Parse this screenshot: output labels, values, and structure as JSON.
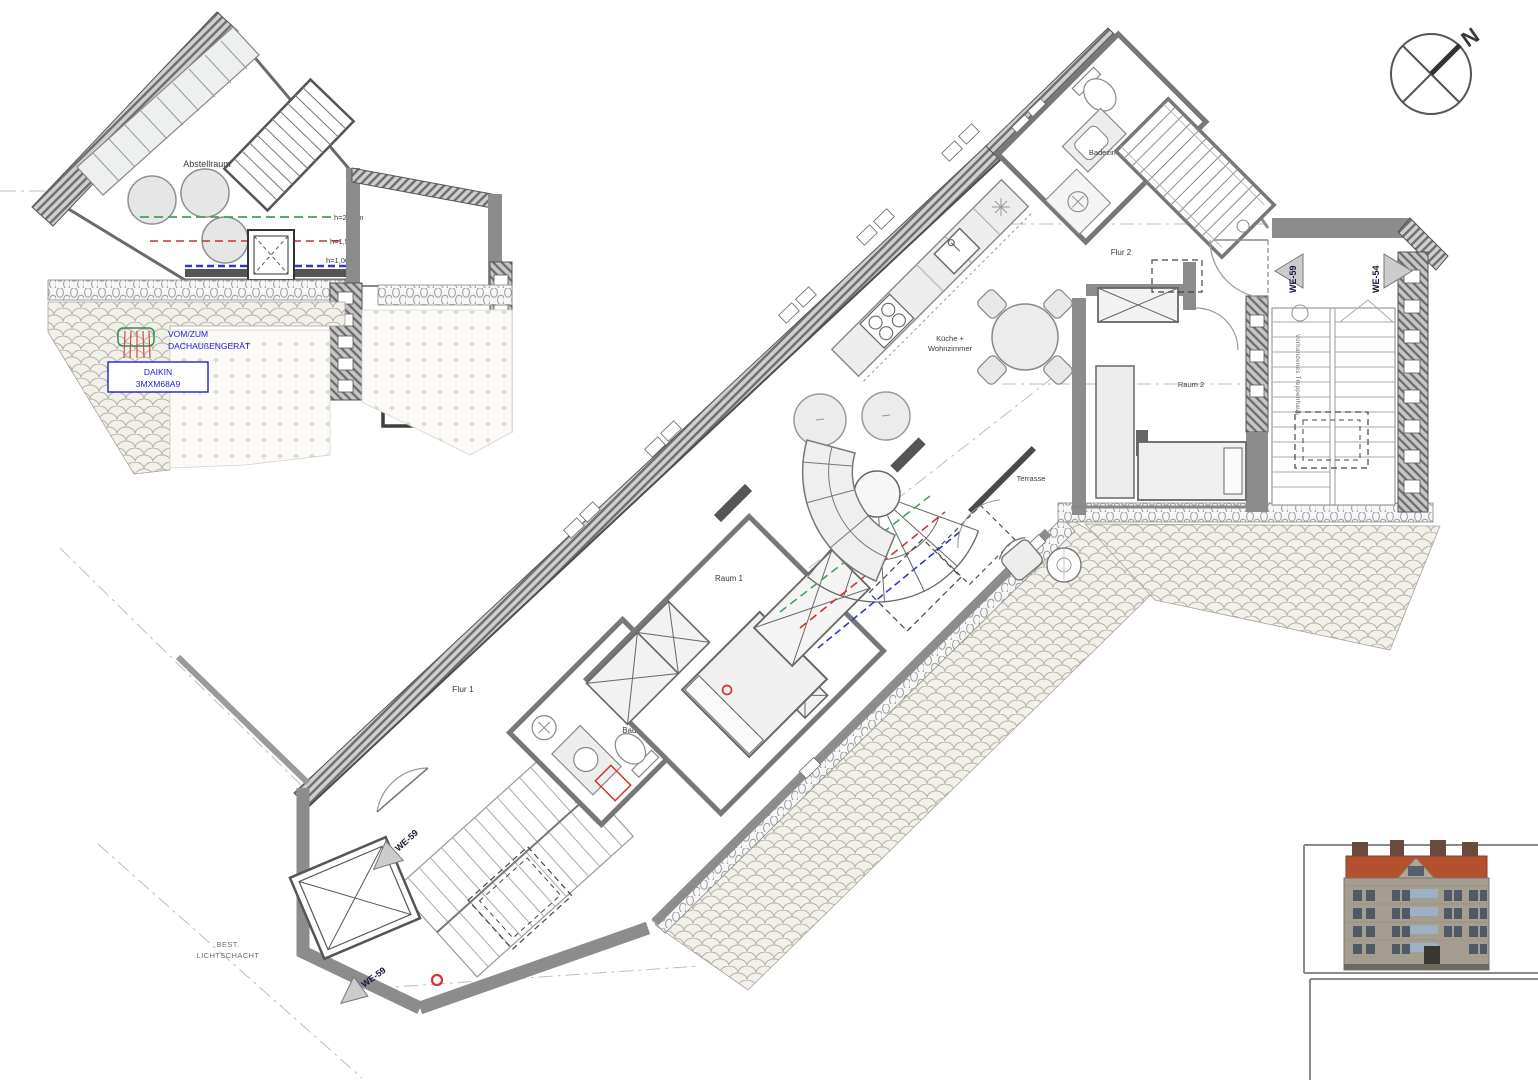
{
  "labels": {
    "abstellraum": "Abstellraum",
    "flur1": "Flur 1",
    "flur2": "Flur 2",
    "raum1": "Raum 1",
    "raum2": "Raum 2",
    "badezimmer1": "Badezimmer 1",
    "badezimmer2": "Badezimmer 2",
    "kueche1": "Küche +",
    "kueche2": "Wohnzimmer",
    "terrasse": "Terrasse",
    "treppenhaus_right": "Vorhandenes Treppenhaus",
    "treppenhaus_unten": "Vorhandenes Treppenhaus",
    "lichtschacht1": "BEST.",
    "lichtschacht2": "LICHTSCHACHT",
    "north": "N"
  },
  "markers": {
    "we59": "WE-59",
    "we54": "WE-54"
  },
  "height_lines": {
    "green": {
      "label": "h=2,00m",
      "color": "#3fa45b"
    },
    "red": {
      "label": "h=1,50m",
      "color": "#c93434"
    },
    "blue": {
      "label": "h=1,00m",
      "color": "#3038c8"
    }
  },
  "hvac": {
    "route1": "VOM/ZUM",
    "route2": "DACHAUßENGERÄT",
    "unit1": "DAIKIN",
    "unit2": "3MXM68A9"
  },
  "colors": {
    "wall": "#8c8c8c",
    "annotation_blue": "#2020cf",
    "roof_red": "#b5502f",
    "marker_red": "#d33333"
  }
}
